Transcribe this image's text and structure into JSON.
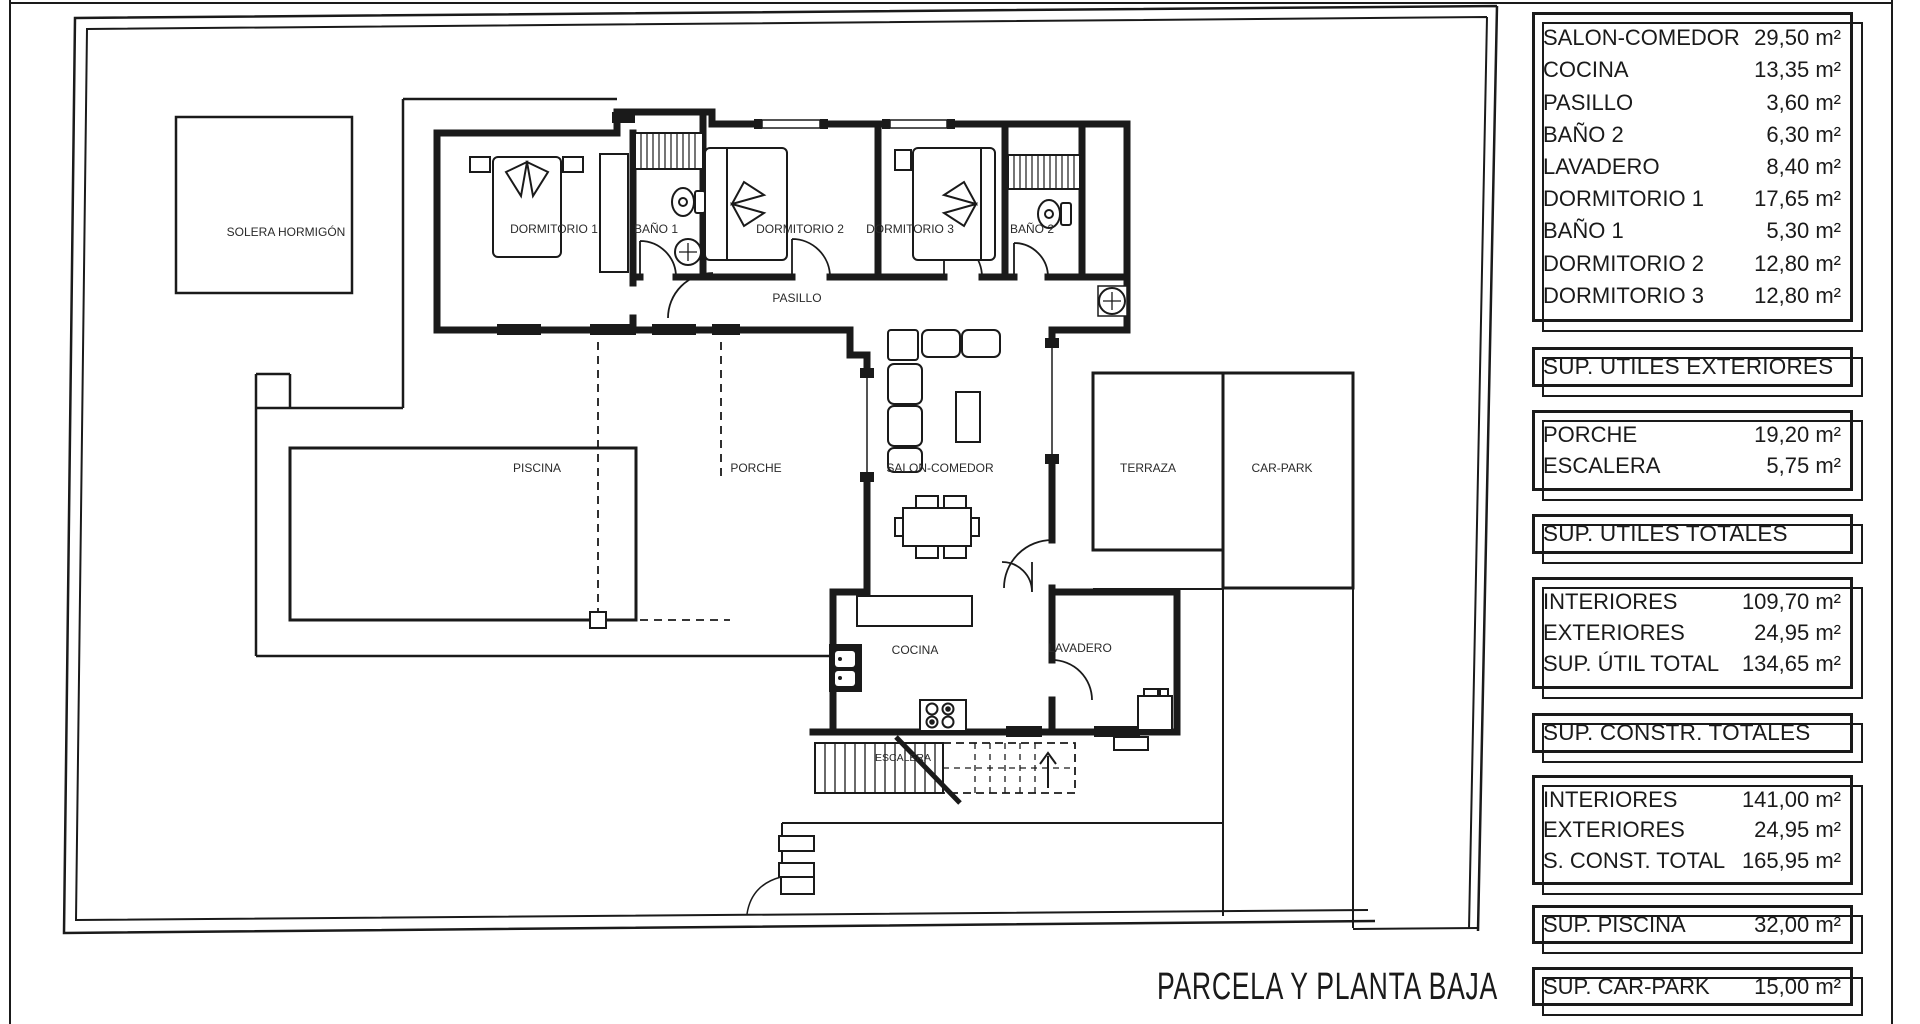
{
  "sheet": {
    "title": "PARCELA Y PLANTA BAJA"
  },
  "colors": {
    "ink": "#1a1a1a",
    "paper": "#ffffff"
  },
  "plan": {
    "labels": {
      "solera": "SOLERA HORMIGÓN",
      "dormitorio1": "DORMITORIO 1",
      "bano1": "BAÑO 1",
      "dormitorio2": "DORMITORIO 2",
      "dormitorio3": "DORMITORIO 3",
      "bano2": "BAÑO 2",
      "pasillo": "PASILLO",
      "piscina": "PISCINA",
      "porche": "PORCHE",
      "salon": "SALON-COMEDOR",
      "terraza": "TERRAZA",
      "carpark": "CAR-PARK",
      "cocina": "COCINA",
      "lavadero": "LAVADERO",
      "escalera": "ESCALERA"
    }
  },
  "panels": {
    "interior_rooms": {
      "rows": [
        {
          "label": "SALON-COMEDOR",
          "value": "29,50 m²"
        },
        {
          "label": "COCINA",
          "value": "13,35 m²"
        },
        {
          "label": "PASILLO",
          "value": "3,60 m²"
        },
        {
          "label": "BAÑO 2",
          "value": "6,30 m²"
        },
        {
          "label": "LAVADERO",
          "value": "8,40 m²"
        },
        {
          "label": "DORMITORIO 1",
          "value": "17,65 m²"
        },
        {
          "label": "BAÑO 1",
          "value": "5,30 m²"
        },
        {
          "label": "DORMITORIO 2",
          "value": "12,80 m²"
        },
        {
          "label": "DORMITORIO 3",
          "value": "12,80 m²"
        }
      ]
    },
    "header_exteriores": "SUP. UTILES EXTERIORES",
    "exterior_rooms": {
      "rows": [
        {
          "label": "PORCHE",
          "value": "19,20 m²"
        },
        {
          "label": "ESCALERA",
          "value": "5,75 m²"
        }
      ]
    },
    "header_utiles_totales": "SUP. UTILES TOTALES",
    "utiles_totales": {
      "rows": [
        {
          "label": "INTERIORES",
          "value": "109,70 m²"
        },
        {
          "label": "EXTERIORES",
          "value": "24,95 m²"
        },
        {
          "label": "SUP. ÚTIL TOTAL",
          "value": "134,65 m²"
        }
      ]
    },
    "header_constr_totales": "SUP. CONSTR. TOTALES",
    "constr_totales": {
      "rows": [
        {
          "label": "INTERIORES",
          "value": "141,00 m²"
        },
        {
          "label": "EXTERIORES",
          "value": "24,95 m²"
        },
        {
          "label": "S. CONST. TOTAL",
          "value": "165,95 m²"
        }
      ]
    },
    "piscina_row": {
      "label": "SUP. PISCINA",
      "value": "32,00 m²"
    },
    "carpark_row": {
      "label": "SUP. CAR-PARK",
      "value": "15,00 m²"
    }
  }
}
